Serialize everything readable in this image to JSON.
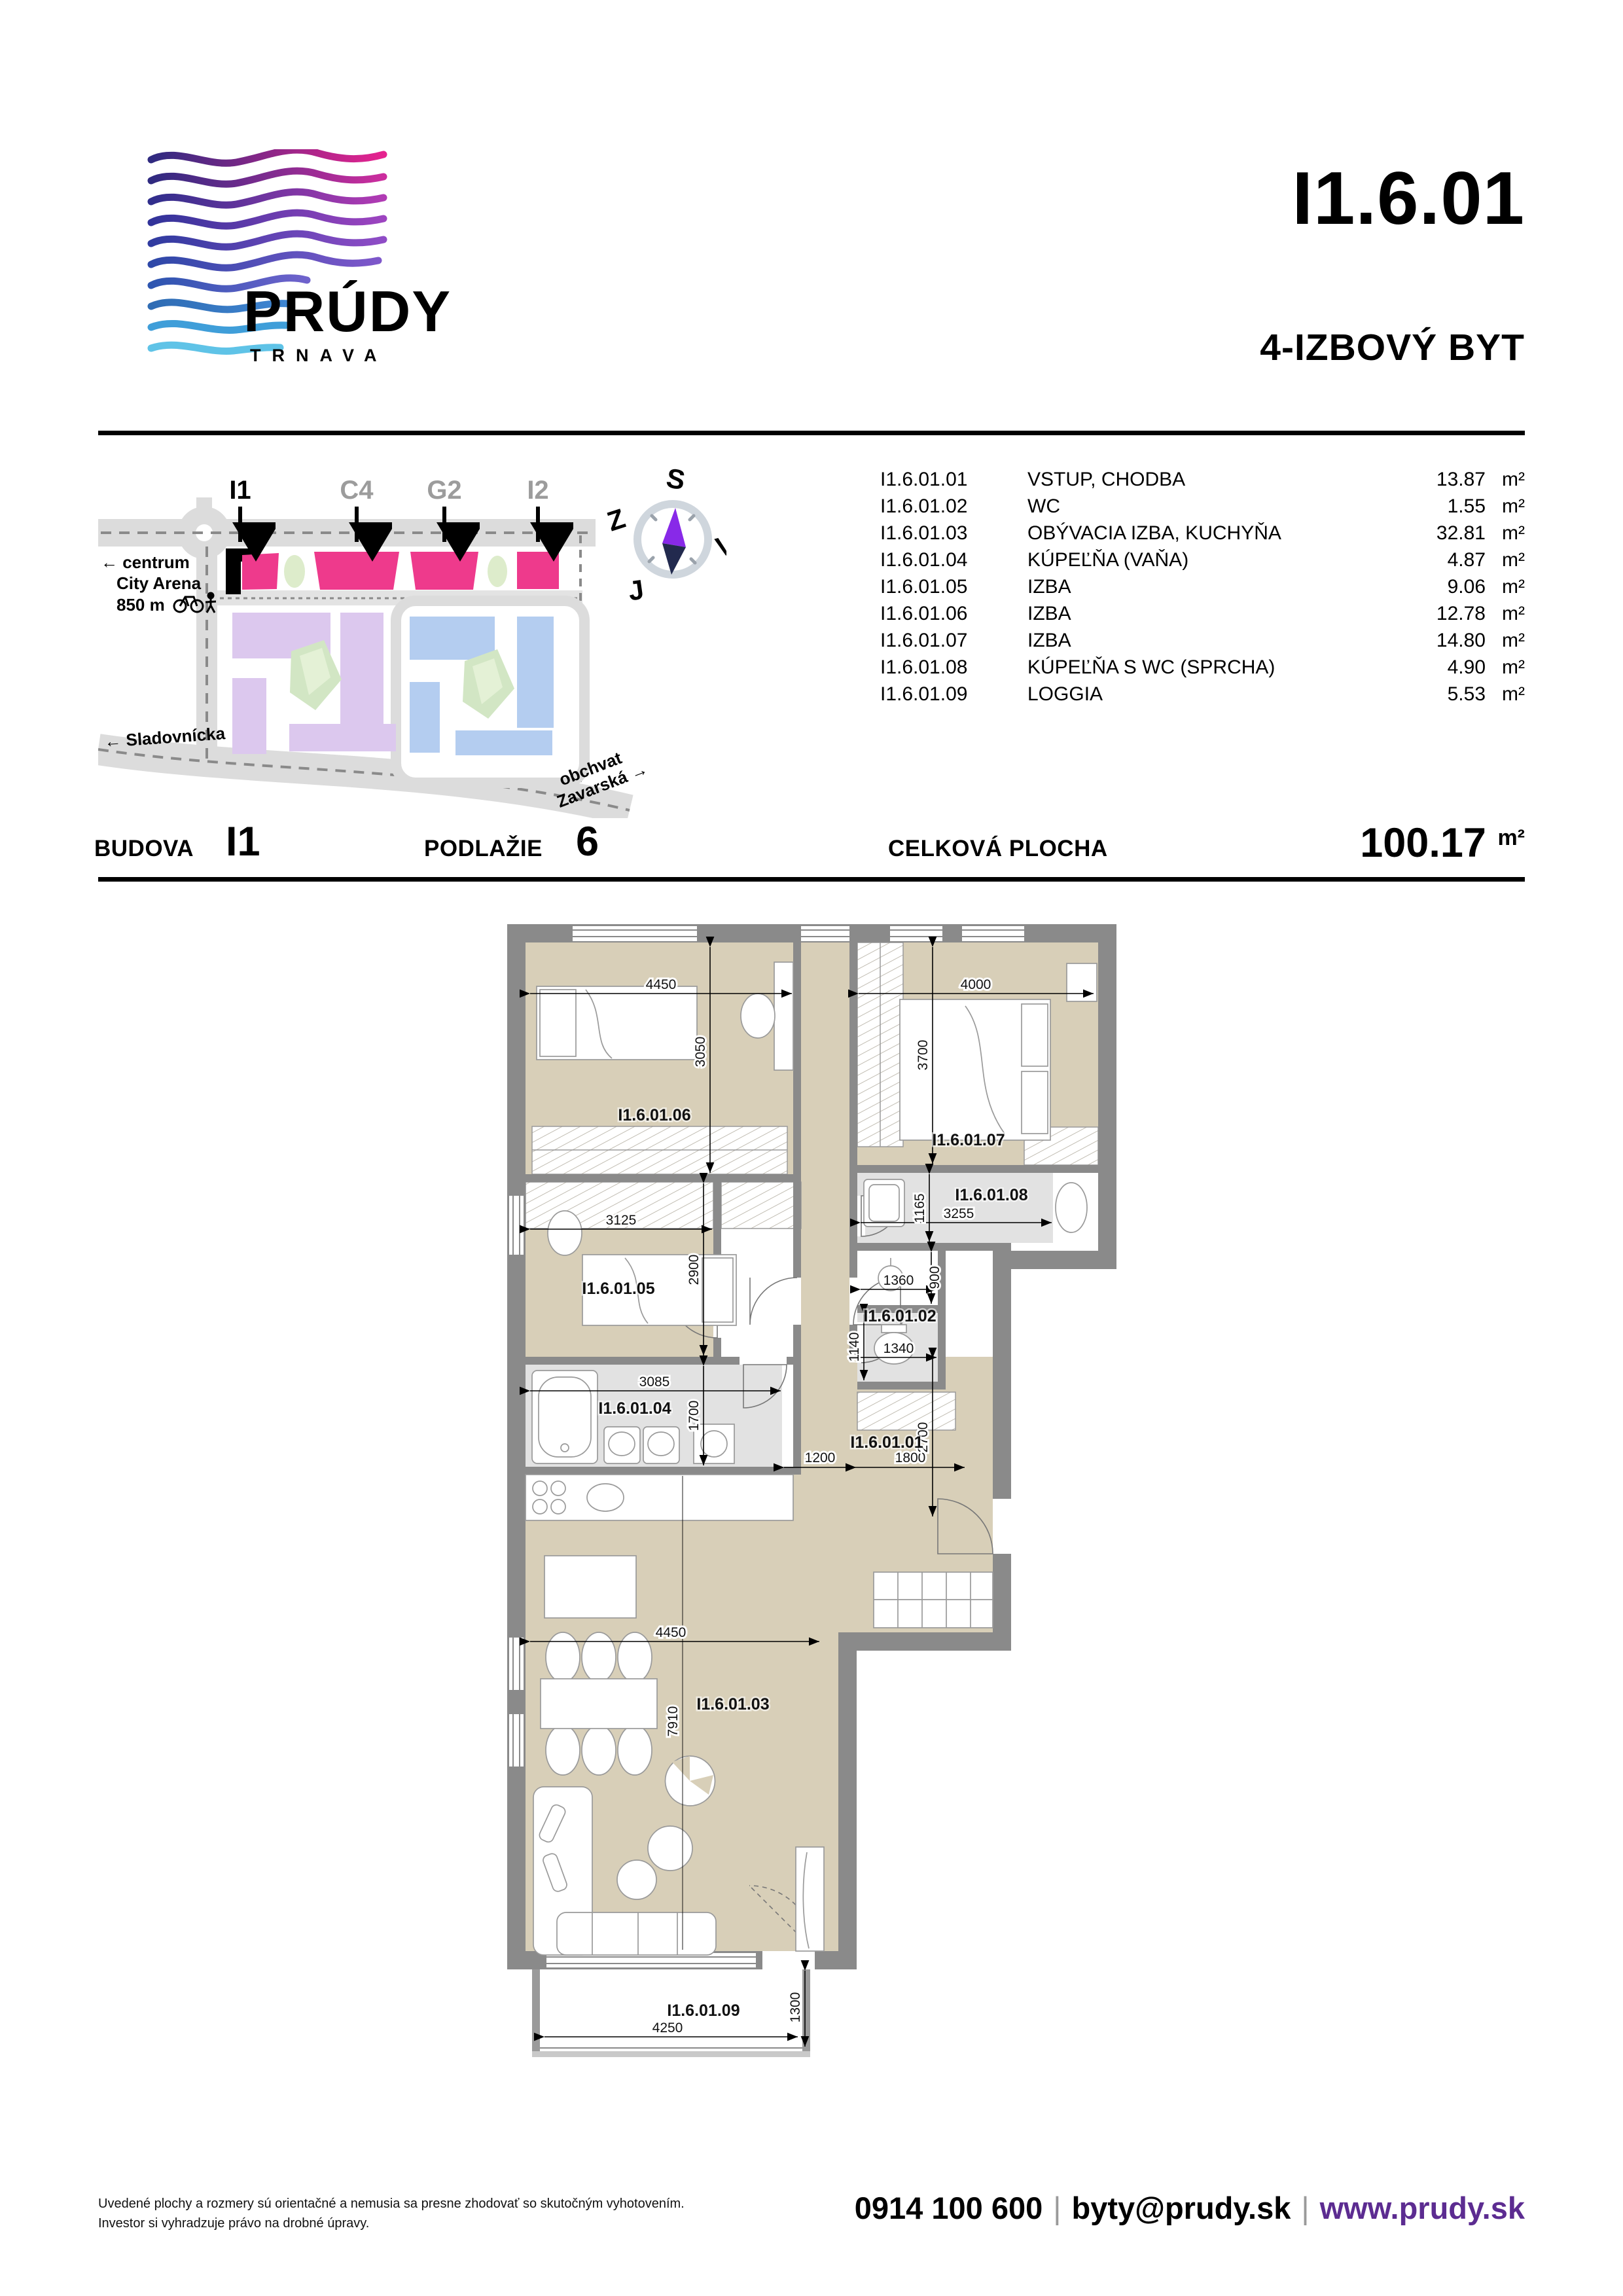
{
  "header": {
    "brand": "PRÚDY",
    "brand_city": "TRNAVA",
    "unit_id": "I1.6.01",
    "unit_type": "4-IZBOVÝ BYT"
  },
  "site_map": {
    "buildings": [
      {
        "label": "I1",
        "highlighted": true
      },
      {
        "label": "C4",
        "highlighted": false
      },
      {
        "label": "G2",
        "highlighted": false
      },
      {
        "label": "I2",
        "highlighted": false
      }
    ],
    "note_line1": "← centrum",
    "note_line2": "City Arena",
    "note_line3": "850 m",
    "street_left": "← Sladovnícka",
    "street_right_line1": "obchvat",
    "street_right_line2": "Zavarská →",
    "compass": {
      "north": "S",
      "west": "Z",
      "east": "V",
      "south": "J"
    },
    "colors": {
      "building_pink": "#ee3a8c",
      "highlight_black": "#000000",
      "block_purple": "#dcc8ee",
      "block_blue": "#b4cdf0",
      "green": "#d2e6c4",
      "road": "#dcdcdc"
    }
  },
  "area_unit": "m²",
  "rooms": [
    {
      "code": "I1.6.01.01",
      "name": "VSTUP, CHODBA",
      "area": "13.87"
    },
    {
      "code": "I1.6.01.02",
      "name": "WC",
      "area": "1.55"
    },
    {
      "code": "I1.6.01.03",
      "name": "OBÝVACIA IZBA, KUCHYŇA",
      "area": "32.81"
    },
    {
      "code": "I1.6.01.04",
      "name": "KÚPEĽŇA (VAŇA)",
      "area": "4.87"
    },
    {
      "code": "I1.6.01.05",
      "name": "IZBA",
      "area": "9.06"
    },
    {
      "code": "I1.6.01.06",
      "name": "IZBA",
      "area": "12.78"
    },
    {
      "code": "I1.6.01.07",
      "name": "IZBA",
      "area": "14.80"
    },
    {
      "code": "I1.6.01.08",
      "name": "KÚPEĽŇA S WC (SPRCHA)",
      "area": "4.90"
    },
    {
      "code": "I1.6.01.09",
      "name": "LOGGIA",
      "area": "5.53"
    }
  ],
  "summary": {
    "building_label": "BUDOVA",
    "building_value": "I1",
    "floor_label": "PODLAŽIE",
    "floor_value": "6",
    "total_label": "CELKOVÁ PLOCHA",
    "total_value": "100.17",
    "total_unit": "m²"
  },
  "floor_plan": {
    "rooms": {
      "r01": "I1.6.01.01",
      "r02": "I1.6.01.02",
      "r03": "I1.6.01.03",
      "r04": "I1.6.01.04",
      "r05": "I1.6.01.05",
      "r06": "I1.6.01.06",
      "r07": "I1.6.01.07",
      "r08": "I1.6.01.08",
      "r09": "I1.6.01.09"
    },
    "dims": {
      "d4450a": "4450",
      "d3050": "3050",
      "d4000": "4000",
      "d3700": "3700",
      "d3125": "3125",
      "d2900": "2900",
      "d3085": "3085",
      "d1700": "1700",
      "d3255": "3255",
      "d1165": "1165",
      "d1360": "1360",
      "d900": "900",
      "d1340": "1340",
      "d1140": "1140",
      "d1200": "1200",
      "d1800": "1800",
      "d2700": "2700",
      "d4450b": "4450",
      "d7910": "7910",
      "d4250": "4250",
      "d1300": "1300"
    }
  },
  "footer": {
    "disclaimer1": "Uvedené plochy a rozmery sú orientačné a nemusia sa presne zhodovať so skutočným vyhotovením.",
    "disclaimer2": "Investor si vyhradzuje právo na drobné úpravy.",
    "phone": "0914 100 600",
    "email": "byty@prudy.sk",
    "website": "www.prudy.sk",
    "separator": "|"
  }
}
